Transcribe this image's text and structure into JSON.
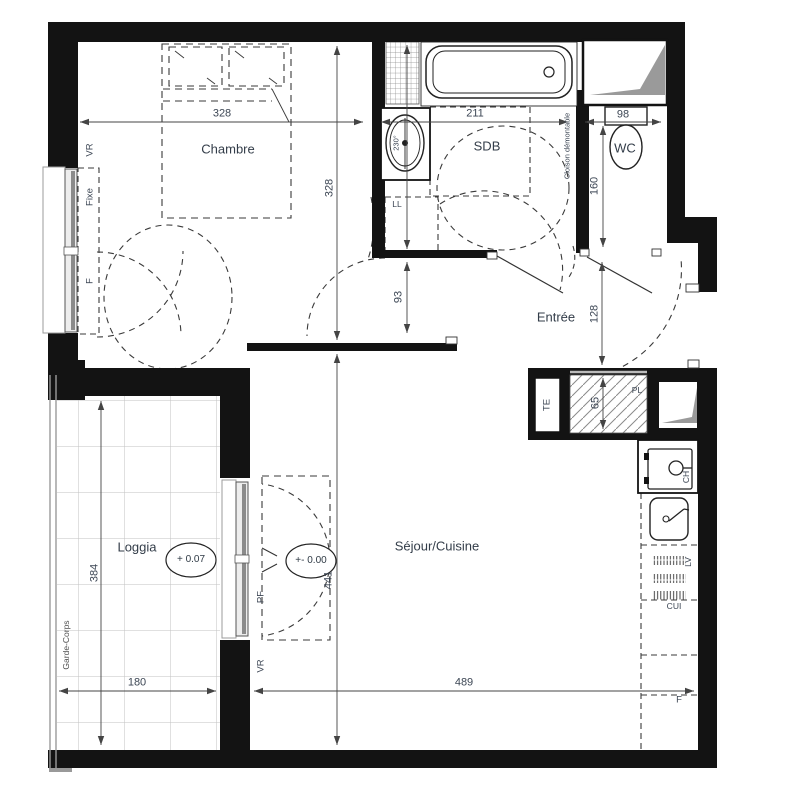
{
  "canvas": {
    "width": 802,
    "height": 800
  },
  "colors": {
    "wall": "#131313",
    "dim_line": "#444444",
    "label_text": "#3c4654",
    "room_text": "#333d49",
    "duct_gray": "#9a9a9a",
    "grid_gray": "#c2c2c2",
    "hatch_gray": "#8a8a8a"
  },
  "rooms": [
    {
      "label": "Chambre"
    },
    {
      "label": "SDB"
    },
    {
      "label": "WC"
    },
    {
      "label": "Entrée"
    },
    {
      "label": "Loggia"
    },
    {
      "label": "Séjour/Cuisine"
    }
  ],
  "levels": [
    {
      "label": "+ 0.07"
    },
    {
      "label": "+- 0.00"
    }
  ],
  "dims": {
    "chambre_w": "328",
    "sdb_w": "211",
    "wc_w": "98",
    "chambre_h": "328",
    "wc_h": "160",
    "door_h": "93",
    "entree_h": "128",
    "pl_h": "65",
    "loggia_h": "384",
    "loggia_w": "180",
    "sejour_h": "441",
    "sejour_w": "489"
  },
  "ann": {
    "vr_chambre": "VR",
    "fixe": "Fixe",
    "f_window": "F",
    "ll": "LL",
    "basin": "230°",
    "cloison": "Cloison démontable",
    "te": "TE",
    "pl": "PL",
    "ch": "CH",
    "lv": "LV",
    "cui": "CUI",
    "fridge": "F",
    "pf": "PF",
    "vr_sejour": "VR",
    "garde_corps": "Garde-Corps"
  }
}
